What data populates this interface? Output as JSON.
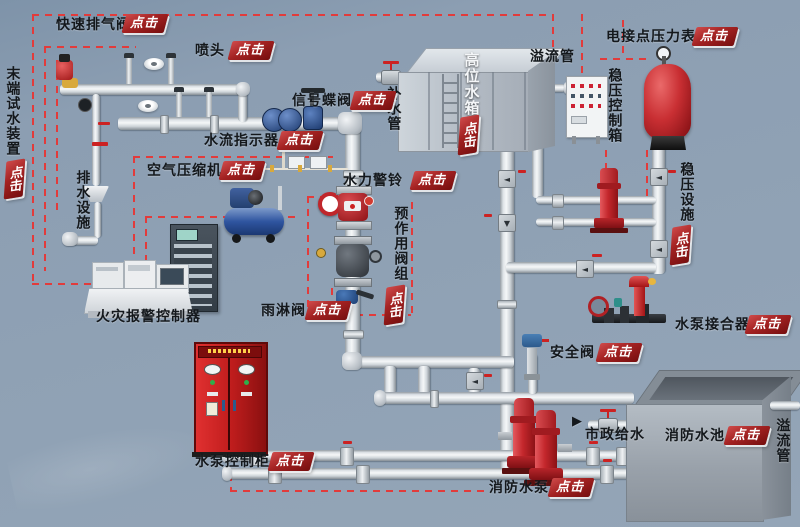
{
  "click": "点击",
  "glyphs": {
    "flow_right": "▶",
    "check_left": "◄",
    "flow_down": "▼"
  },
  "colors": {
    "background": "#8c9eb2",
    "dashed_leader": "#e23b3b",
    "button_red": "#a32222",
    "pipe_light": "#f5f7f8",
    "pipe_dark": "#858d94",
    "equipment_red": "#c4272c"
  },
  "labels": {
    "quick_exhaust": "快速排气阀",
    "sprinkler": "喷头",
    "end_test": "末端试水装置",
    "drainage": "排水设施",
    "flow_indicator": "水流指示器",
    "signal_valve": "信号蝶阀",
    "air_compressor": "空气压缩机",
    "fire_alarm": "火灾报警控制器",
    "hydraulic_bell": "水力警铃",
    "preaction": "预作用阀组",
    "deluge": "雨淋阀",
    "makeup_pipe": "补水管",
    "high_tank": "高位水箱",
    "overflow_top": "溢流管",
    "contact_gauge": "电接点压力表",
    "press_box": "稳压控制箱",
    "press_facility": "稳压设施",
    "coupler": "水泵接合器",
    "safety_valve": "安全阀",
    "municipal": "市政给水",
    "pool": "消防水池",
    "overflow_right": "溢流管",
    "fire_pump": "消防水泵",
    "pump_cabinet": "水泵控制柜"
  }
}
